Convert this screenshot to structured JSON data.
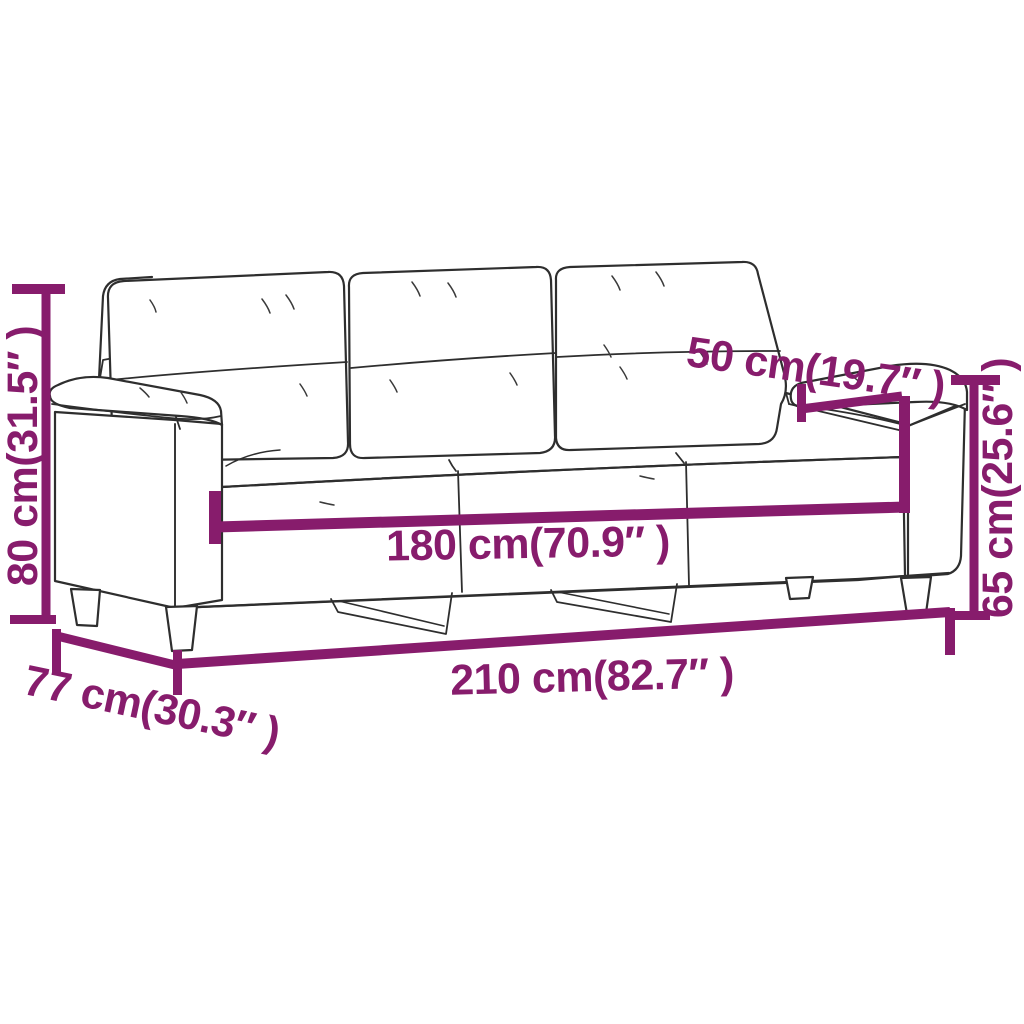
{
  "page": {
    "description": "Line-art dimension diagram of a 3-seater sofa on white background",
    "background": "#FFFFFF"
  },
  "colors": {
    "dimension_accent": "#871C6C",
    "line_art": "#2E2E2E",
    "background": "#FFFFFF"
  },
  "diagram": {
    "subject": "3-seater sofa",
    "dimensions": {
      "overall_height": {
        "label": "80 cm(31.5″ )",
        "cm": 80,
        "inches": 31.5,
        "orientation": "vertical-left"
      },
      "base_depth": {
        "label": "77 cm(30.3″ )",
        "cm": 77,
        "inches": 30.3,
        "orientation": "diagonal-bottom-left"
      },
      "overall_width": {
        "label": "210 cm(82.7″ )",
        "cm": 210,
        "inches": 82.7,
        "orientation": "horizontal-bottom"
      },
      "inner_width": {
        "label": "180 cm(70.9″ )",
        "cm": 180,
        "inches": 70.9,
        "orientation": "horizontal-middle"
      },
      "seat_depth": {
        "label": "50 cm(19.7″ )",
        "cm": 50,
        "inches": 19.7,
        "orientation": "diagonal-top-right"
      },
      "arm_height": {
        "label": "65 cm(25.6″ )",
        "cm": 65,
        "inches": 25.6,
        "orientation": "vertical-right"
      }
    }
  }
}
